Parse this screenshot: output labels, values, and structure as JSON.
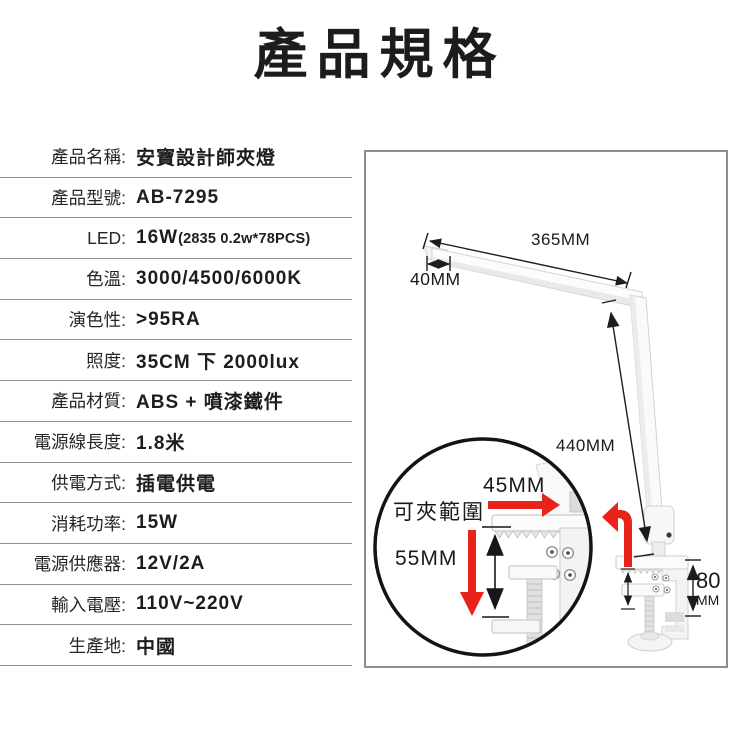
{
  "title": "產品規格",
  "specs": {
    "rows": [
      {
        "label": "產品名稱:",
        "value": "安寶設計師夾燈",
        "value_small": ""
      },
      {
        "label": "產品型號:",
        "value": "AB-7295",
        "value_small": ""
      },
      {
        "label": "LED:",
        "value": "16W",
        "value_small": "(2835 0.2w*78PCS)"
      },
      {
        "label": "色溫:",
        "value": "3000/4500/6000K",
        "value_small": ""
      },
      {
        "label": "演色性:",
        "value": ">95RA",
        "value_small": ""
      },
      {
        "label": "照度:",
        "value": "35CM 下 2000lux",
        "value_small": ""
      },
      {
        "label": "產品材質:",
        "value": "ABS + 噴漆鐵件",
        "value_small": ""
      },
      {
        "label": "電源線長度:",
        "value": "1.8米",
        "value_small": ""
      },
      {
        "label": "供電方式:",
        "value": "插電供電",
        "value_small": ""
      },
      {
        "label": "消耗功率:",
        "value": "15W",
        "value_small": ""
      },
      {
        "label": "電源供應器:",
        "value": "12V/2A",
        "value_small": ""
      },
      {
        "label": "輸入電壓:",
        "value": "110V~220V",
        "value_small": ""
      },
      {
        "label": "生產地:",
        "value": "中國",
        "value_small": ""
      }
    ]
  },
  "diagram": {
    "arm_length": "365MM",
    "head_width": "40MM",
    "pole_length": "440MM",
    "clamp_depth": "45MM",
    "clamp_range_label": "可夾範圍",
    "clamp_range": "55MM",
    "base_height": "80",
    "base_height_unit": "MM"
  },
  "colors": {
    "accent_red": "#e8231a",
    "text": "#1c1c1c",
    "divider": "#929292",
    "panel_border": "#8e8e8e"
  }
}
